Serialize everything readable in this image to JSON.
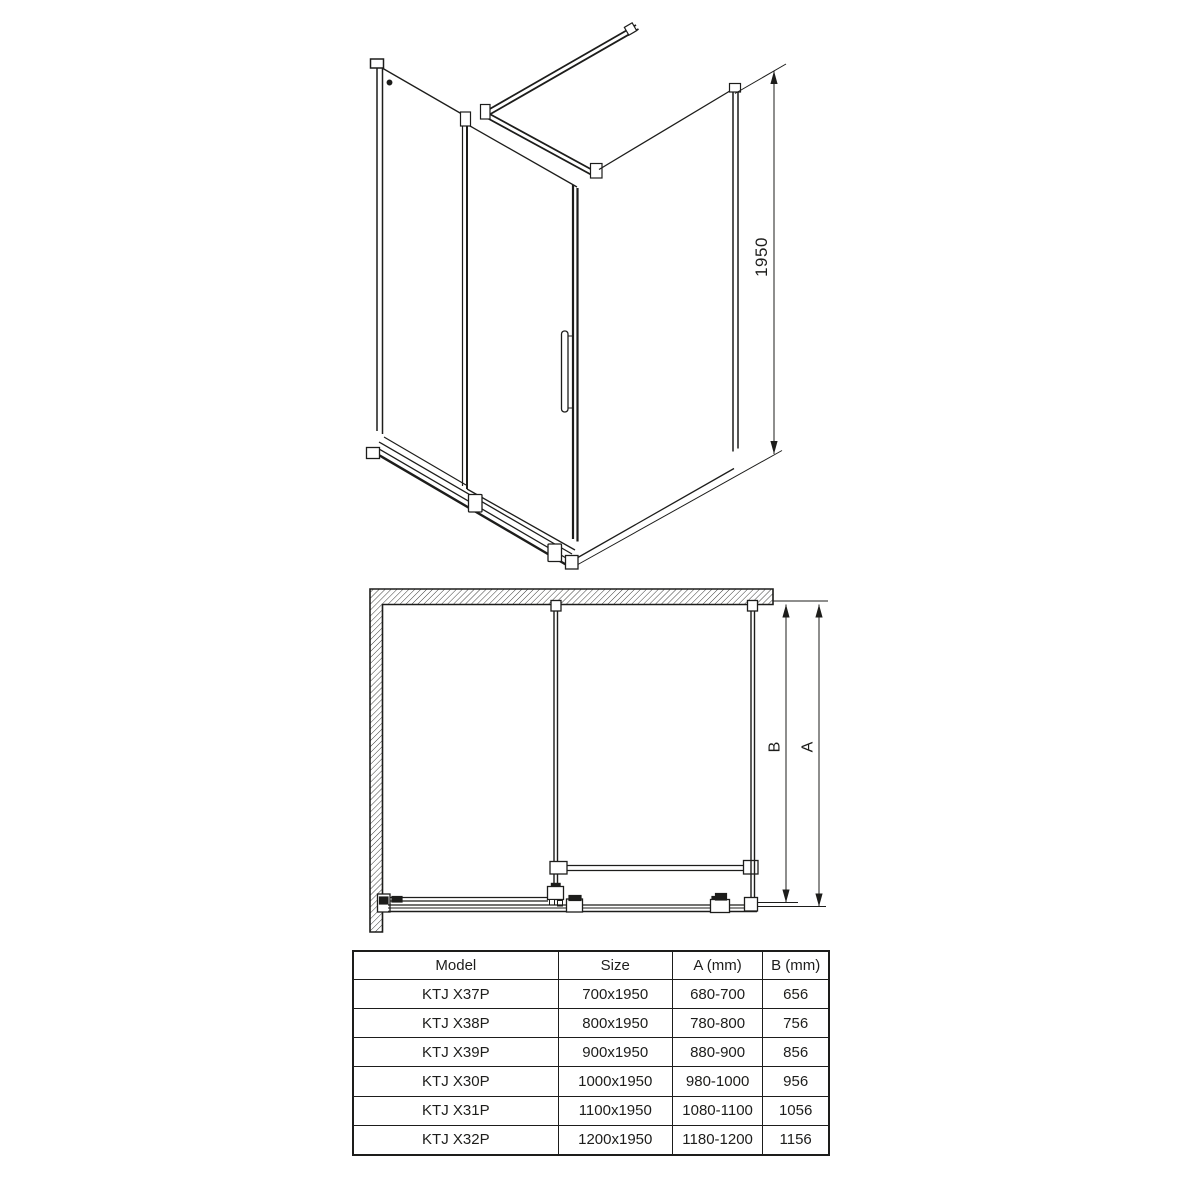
{
  "page": {
    "background_color": "#ffffff",
    "line_color": "#1d1d1b"
  },
  "iso_view": {
    "description": "isometric technical drawing of corner shower enclosure with sliding door, side panel and top support bars",
    "height_dimension": "1950"
  },
  "plan_view": {
    "description": "top plan view of enclosure against hatched wall with depth dimensions",
    "dim_a_label": "A",
    "dim_b_label": "B"
  },
  "table": {
    "headers": [
      "Model",
      "Size",
      "A (mm)",
      "B (mm)"
    ],
    "rows": [
      [
        "KTJ X37P",
        "700x1950",
        "680-700",
        "656"
      ],
      [
        "KTJ X38P",
        "800x1950",
        "780-800",
        "756"
      ],
      [
        "KTJ X39P",
        "900x1950",
        "880-900",
        "856"
      ],
      [
        "KTJ X30P",
        "1000x1950",
        "980-1000",
        "956"
      ],
      [
        "KTJ X31P",
        "1100x1950",
        "1080-1100",
        "1056"
      ],
      [
        "KTJ X32P",
        "1200x1950",
        "1180-1200",
        "1156"
      ]
    ]
  }
}
